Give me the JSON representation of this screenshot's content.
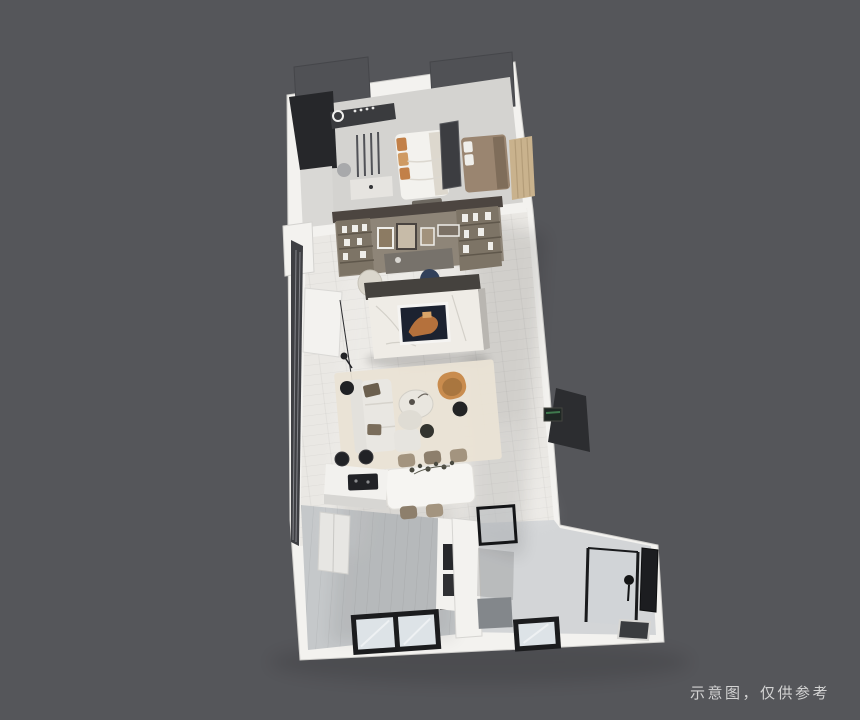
{
  "watermark": {
    "text": "示意图，仅供参考"
  },
  "scene": {
    "type": "3d-floorplan-render",
    "view": "top-down dollhouse cutaway",
    "areas": [
      "master-bedroom",
      "bathroom",
      "second-bedroom",
      "wardrobe",
      "study-nook",
      "tv-wall",
      "living-room",
      "dining-area",
      "kitchen-island",
      "kitchen",
      "entry-hall",
      "shower-room",
      "balcony-windows"
    ]
  },
  "palette": {
    "bg": "#55565a",
    "watermark": "#dedede",
    "wallTop": "#f3f2ef",
    "wallFace": "#d9d8d5",
    "floorBedroom": "#d4d3d0",
    "floorLiving": "#eae8e4",
    "floorKitchen": "#c5c8ca",
    "floorEntry": "#d3d5d7",
    "cabinetDarkTop": "#505155",
    "panelDarkest": "#26272a",
    "glassWallDark": "#3e3f43",
    "studyBeam": "#4c4540",
    "studyWall": "#8e8578",
    "shelfWood": "#7d7466",
    "marble": "#efece6",
    "artDark": "#1c2230",
    "artOrange": "#b5713c",
    "bedWhite": "#f3f2ee",
    "pillowTan": "#c28048",
    "bedTaupe": "#9a8570",
    "wardrobeTan": "#c9b28d",
    "sofaWhite": "#e9e7e2",
    "pillowBrown": "#6b5f4e",
    "rug": "#eae3d5",
    "chairTan": "#c98c4e",
    "tableWhite": "#f6f5f2",
    "chairTaupe": "#a3947f",
    "black": "#1b1c1e",
    "glassPane": "#dde3e7",
    "matGray": "#83878b"
  }
}
